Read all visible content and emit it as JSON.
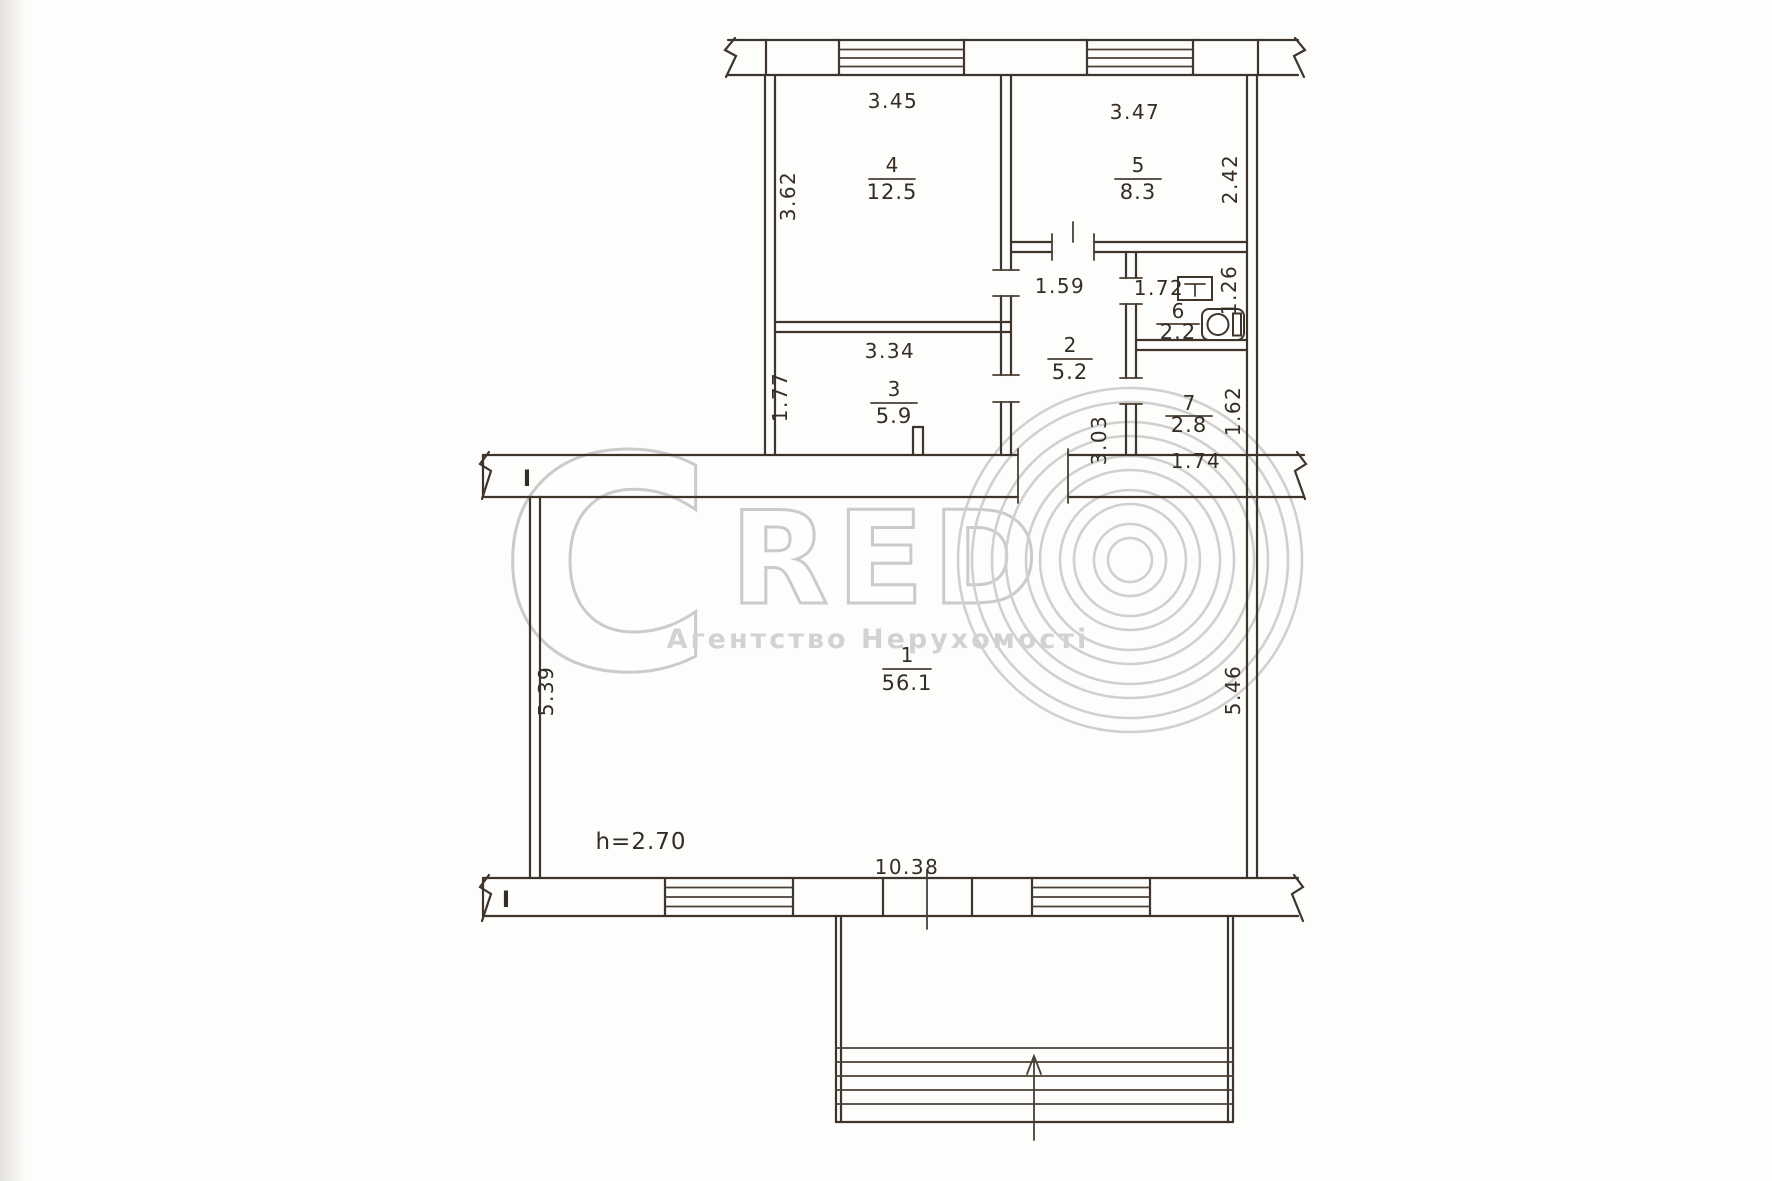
{
  "watermark": {
    "logo_c": "C",
    "logo_red": "RED",
    "subtitle": "Агентство Нерухомості"
  },
  "plan": {
    "section_marks": {
      "top": "I",
      "bottom": "I"
    },
    "rooms": {
      "r1": {
        "num": "1",
        "area": "56.1",
        "width": "10.38",
        "depth_left": "5.39",
        "depth_right": "5.46",
        "height_note": "h=2.70"
      },
      "r2": {
        "num": "2",
        "area": "5.2",
        "width": "1.59",
        "depth": "3.03"
      },
      "r3": {
        "num": "3",
        "area": "5.9",
        "width": "3.34",
        "depth": "1.77"
      },
      "r4": {
        "num": "4",
        "area": "12.5",
        "width": "3.45",
        "depth": "3.62"
      },
      "r5": {
        "num": "5",
        "area": "8.3",
        "width": "3.47",
        "depth": "2.42"
      },
      "r6": {
        "num": "6",
        "area": "2.2",
        "width": "1.72",
        "depth": "1.26"
      },
      "r7": {
        "num": "7",
        "area": "2.8",
        "width": "1.74",
        "depth": "1.62"
      }
    }
  }
}
